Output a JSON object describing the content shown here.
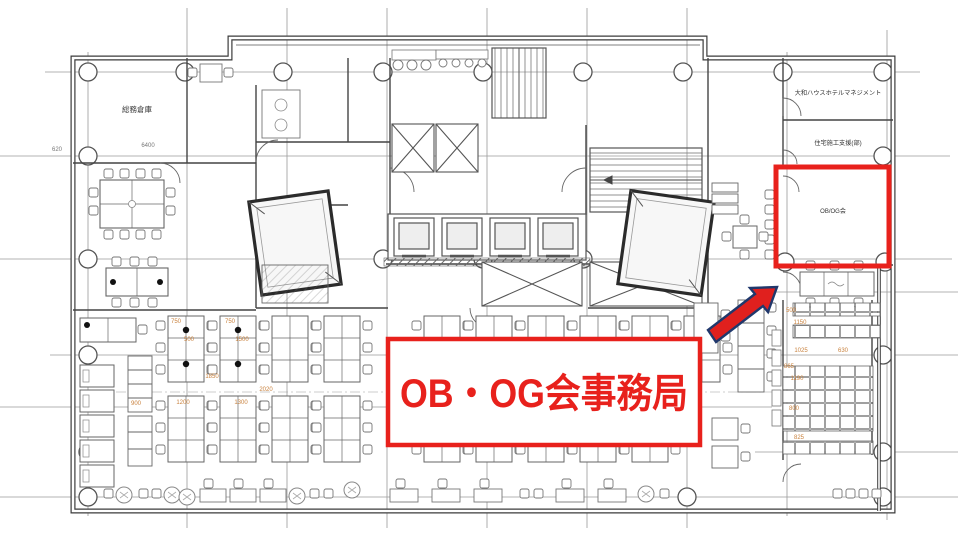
{
  "annotations": {
    "callout_label": "OB・OG会事務局",
    "highlighted_room_label": "OB/OG会"
  },
  "rooms": {
    "storage": "総務倉庫",
    "hotel_management": "大和ハウスホテルマネジメント",
    "housing_support": "住宅施工支援(部)"
  },
  "dimensions": [
    {
      "t": "620"
    },
    {
      "t": "6400"
    },
    {
      "t": "750"
    },
    {
      "t": "750"
    },
    {
      "t": "500"
    },
    {
      "t": "1500"
    },
    {
      "t": "1850"
    },
    {
      "t": "2020"
    },
    {
      "t": "900"
    },
    {
      "t": "1200"
    },
    {
      "t": "1300"
    },
    {
      "t": "500"
    },
    {
      "t": "1150"
    },
    {
      "t": "1025"
    },
    {
      "t": "630"
    },
    {
      "t": "865"
    },
    {
      "t": "1190"
    },
    {
      "t": "800"
    },
    {
      "t": "825"
    }
  ],
  "colors": {
    "highlight_red": "#e8211c",
    "arrow_red": "#e0201e",
    "arrow_outline_navy": "#20386c",
    "callout_text_red": "#e8211c",
    "dimension_orange": "#c9823e",
    "dimension_gray": "#777777",
    "line_dark": "#3c3c3c"
  }
}
